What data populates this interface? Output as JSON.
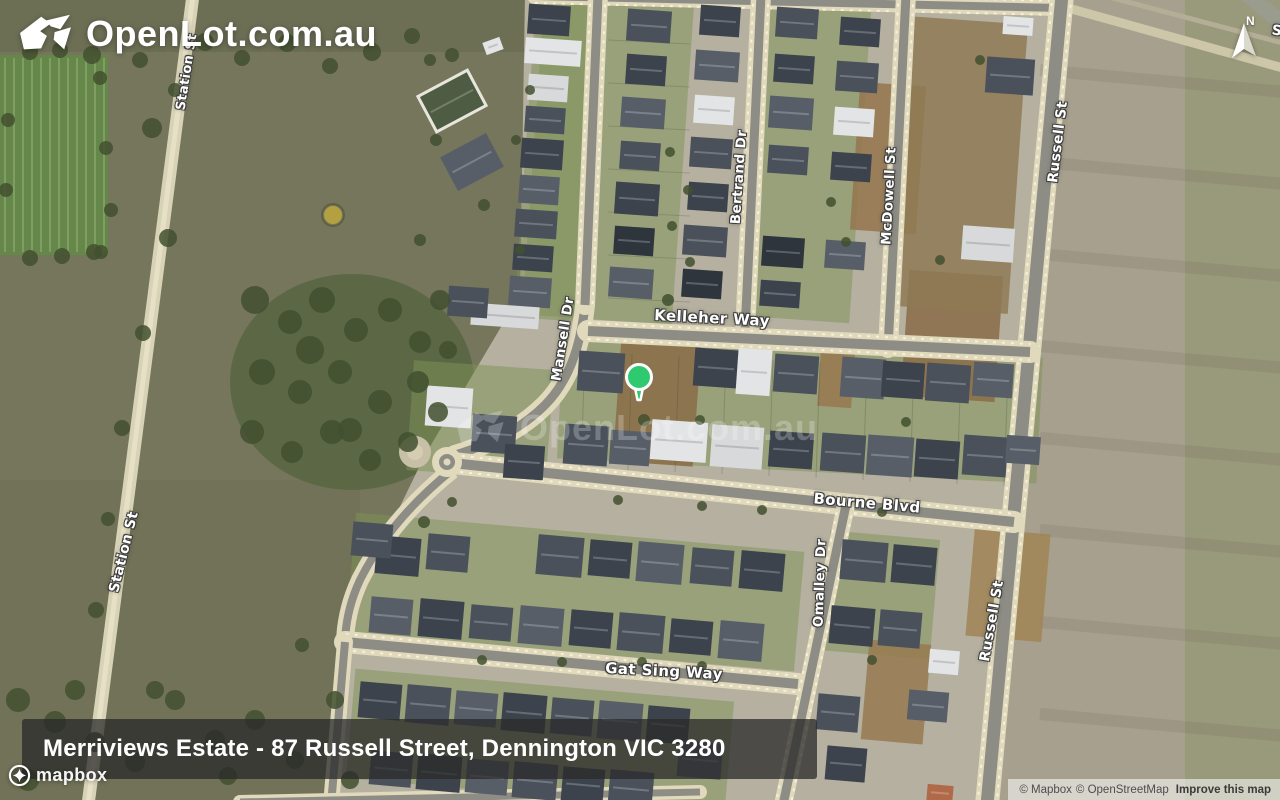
{
  "branding": {
    "logo_text": "OpenLot.com.au",
    "watermark_text": "OpenLot.com.au"
  },
  "compass": {
    "label": "N"
  },
  "marker": {
    "color": "#2fca70",
    "outline": "#ffffff",
    "x": 639,
    "y": 378
  },
  "title_bar": {
    "text": "Merriviews Estate - 87 Russell Street, Dennington VIC 3280"
  },
  "map_provider": {
    "logo_text": "mapbox"
  },
  "attribution": {
    "mapbox": "© Mapbox",
    "osm": "© OpenStreetMap",
    "improve_link": "Improve this map"
  },
  "street_labels": [
    {
      "id": "station-st-top",
      "text": "Station St",
      "x": 187,
      "y": 72,
      "rot": -81,
      "size": 13
    },
    {
      "id": "station-st",
      "text": "Station St",
      "x": 124,
      "y": 552,
      "rot": -76,
      "size": 14
    },
    {
      "id": "mansell-dr",
      "text": "Mansell Dr",
      "x": 563,
      "y": 339,
      "rot": -81,
      "size": 13.5
    },
    {
      "id": "bertrand-dr",
      "text": "Bertrand Dr",
      "x": 739,
      "y": 177,
      "rot": -86,
      "size": 13.5
    },
    {
      "id": "mcdowell-st",
      "text": "McDowell St",
      "x": 889,
      "y": 196,
      "rot": -87,
      "size": 13.5
    },
    {
      "id": "russell-st-top",
      "text": "Russell St",
      "x": 1058,
      "y": 142,
      "rot": -83,
      "size": 14
    },
    {
      "id": "russell-st-south",
      "text": "Russell St",
      "x": 992,
      "y": 621,
      "rot": -80,
      "size": 14
    },
    {
      "id": "kelleher-way",
      "text": "Kelleher Way",
      "x": 712,
      "y": 318,
      "rot": 3,
      "size": 15
    },
    {
      "id": "bourne-blvd",
      "text": "Bourne Blvd",
      "x": 867,
      "y": 503,
      "rot": 5,
      "size": 15
    },
    {
      "id": "omalley-dr",
      "text": "Omalley Dr",
      "x": 820,
      "y": 583,
      "rot": -88,
      "size": 13.5
    },
    {
      "id": "gat-sing-way",
      "text": "Gat Sing Way",
      "x": 664,
      "y": 671,
      "rot": 3,
      "size": 15
    },
    {
      "id": "street-s-partial",
      "text": "S",
      "x": 1277,
      "y": 31,
      "rot": 8,
      "size": 14
    }
  ]
}
